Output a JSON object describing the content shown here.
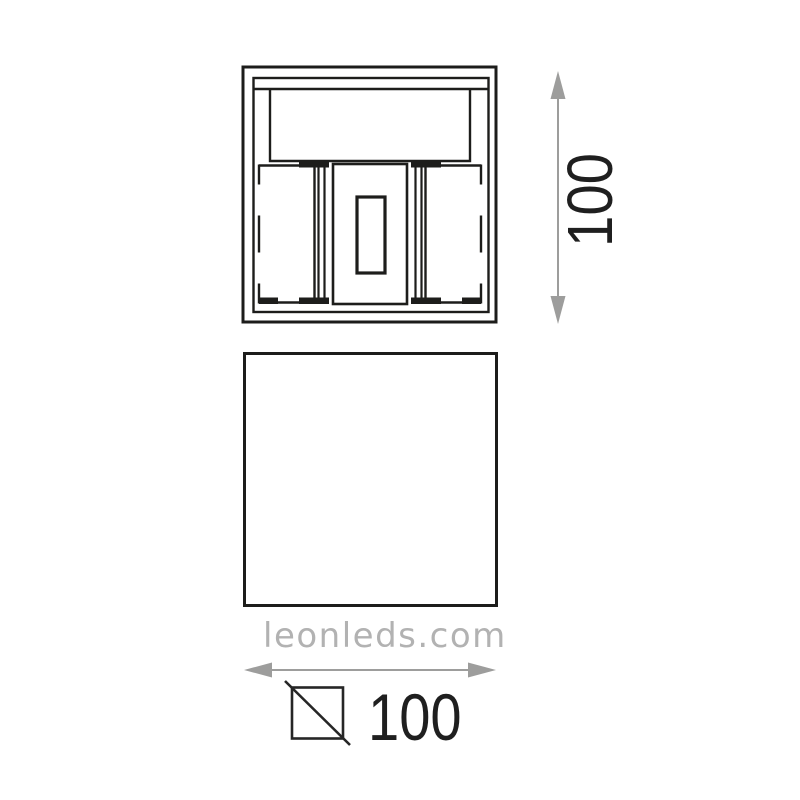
{
  "diagram": {
    "watermark_text": "leonleds.com",
    "height_dimension": {
      "value": "100"
    },
    "width_dimension": {
      "value": "100"
    },
    "colors": {
      "line": "#1d1d1b",
      "arrow": "#9d9d9c",
      "label": "#1f1f1f",
      "symbol": "#262626",
      "watermark": "#b2b2b2",
      "background": "#ffffff"
    },
    "icons": {
      "height_arrow": "double-headed-vertical-arrow-icon",
      "width_arrow": "double-headed-horizontal-arrow-icon",
      "square_symbol": "square-section-symbol-icon"
    }
  }
}
